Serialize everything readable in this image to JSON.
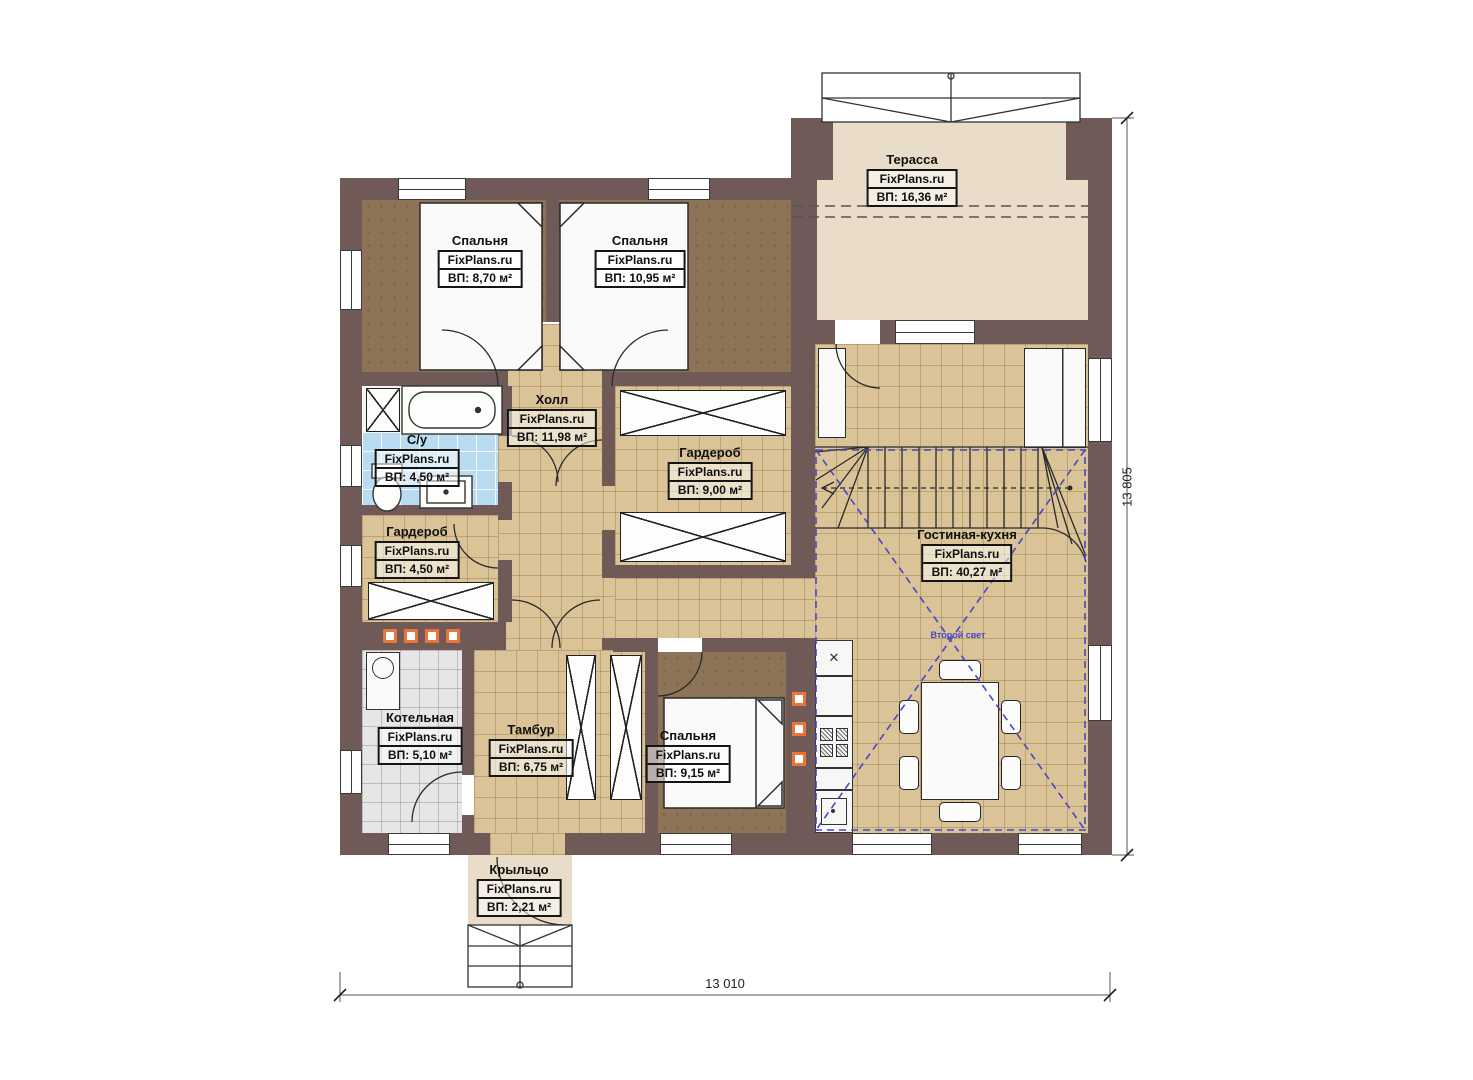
{
  "plan": {
    "brand": "FixPlans.ru",
    "rooms": [
      {
        "id": "terrace",
        "name": "Терасса",
        "area": "ВП: 16,36 м²"
      },
      {
        "id": "bedroom-top-left",
        "name": "Спальня",
        "area": "ВП: 8,70 м²"
      },
      {
        "id": "bedroom-top-right",
        "name": "Спальня",
        "area": "ВП: 10,95 м²"
      },
      {
        "id": "hall",
        "name": "Холл",
        "area": "ВП: 11,98 м²"
      },
      {
        "id": "wardrobe-main",
        "name": "Гардероб",
        "area": "ВП: 9,00 м²"
      },
      {
        "id": "bathroom",
        "name": "С/у",
        "area": "ВП: 4,50 м²"
      },
      {
        "id": "wardrobe-small",
        "name": "Гардероб",
        "area": "ВП: 4,50 м²"
      },
      {
        "id": "boiler-room",
        "name": "Котельная",
        "area": "ВП: 5,10 м²"
      },
      {
        "id": "vestibule",
        "name": "Тамбур",
        "area": "ВП: 6,75 м²"
      },
      {
        "id": "bedroom-bottom",
        "name": "Спальня",
        "area": "ВП: 9,15 м²"
      },
      {
        "id": "living-kitchen",
        "name": "Гостиная-кухня",
        "area": "ВП: 40,27 м²"
      },
      {
        "id": "porch",
        "name": "Крыльцо",
        "area": "ВП: 2,21 м²"
      }
    ],
    "annotations": {
      "second_light": "Второй свет"
    },
    "dimensions": {
      "width_label": "13 010",
      "height_label": "13 805"
    },
    "icons": {
      "counter_x": "✕"
    },
    "colors": {
      "wall": "#6f5a57",
      "floor_tile_tan": "#d9c397",
      "floor_bedroom_brown": "#8d7457",
      "floor_bath_blue": "#badcf2",
      "floor_boiler_gray": "#e6e6e6",
      "floor_terrace_beige": "#e9ddc9",
      "vent_orange": "#e8763a",
      "second_light_blue": "#4747c9"
    }
  }
}
